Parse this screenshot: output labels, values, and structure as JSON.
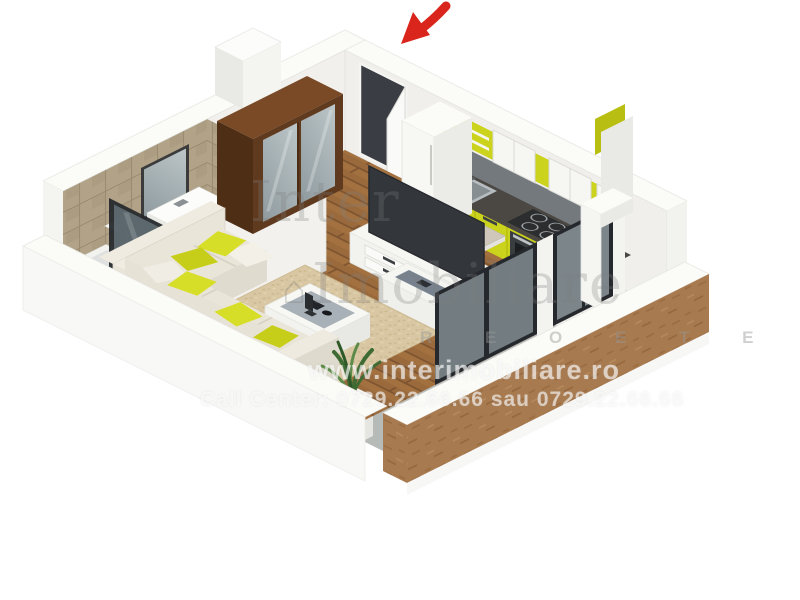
{
  "image": {
    "type": "3d-floor-plan-render",
    "view": "isometric",
    "background": "#ffffff"
  },
  "rooms": [
    "hallway",
    "bathroom",
    "kitchen",
    "living room",
    "balcony"
  ],
  "entrance_arrow": {
    "meaning": "entrance direction indicator",
    "color": "#d9251c"
  },
  "watermark": {
    "brand_word1": "Inter",
    "brand_word2": "Imobiliare",
    "logo_glyph": "⌂",
    "spaced_letters_fragment": "R E O E T E",
    "website": "www.interimobiliare.ro",
    "call_center_line": "Call Center: 0729.22.66.66 sau 0729.22.66.66"
  },
  "colors": {
    "wall_white": "#fbfbf8",
    "wall_shade": "#efeeea",
    "wood_floor": "#9a6a3c",
    "wood_floor_line": "#7f5531",
    "bath_tile": "#cbb89c",
    "wall_tile": "#b2a288",
    "white_tile": "#f3f2ee",
    "rug_beige": "#d8c7a2",
    "kitchen_yellow": "#ccd31d",
    "kitchen_yellow_dark": "#b8bf12",
    "counter_dark": "#4b4742",
    "backsplash_gray": "#74797e",
    "tv_dark": "#33363b",
    "door_dark": "#3a3e44",
    "glass_frame": "#25282c",
    "glass_tint": "#b5c3c9",
    "mirror_gray": "#a9b4b8",
    "sofa_cream": "#eae5d9",
    "sofa_shadow": "#e0dbcf",
    "pillow_lime": "#d7de27",
    "balcony_gray": "#b7bbb7",
    "cardboard_brown": "#a87a4f",
    "wardrobe_wood": "#5f3a1e",
    "shelf_gray": "#77828e",
    "plant_green": "#3e6b33",
    "arrow_red": "#d9251c"
  }
}
